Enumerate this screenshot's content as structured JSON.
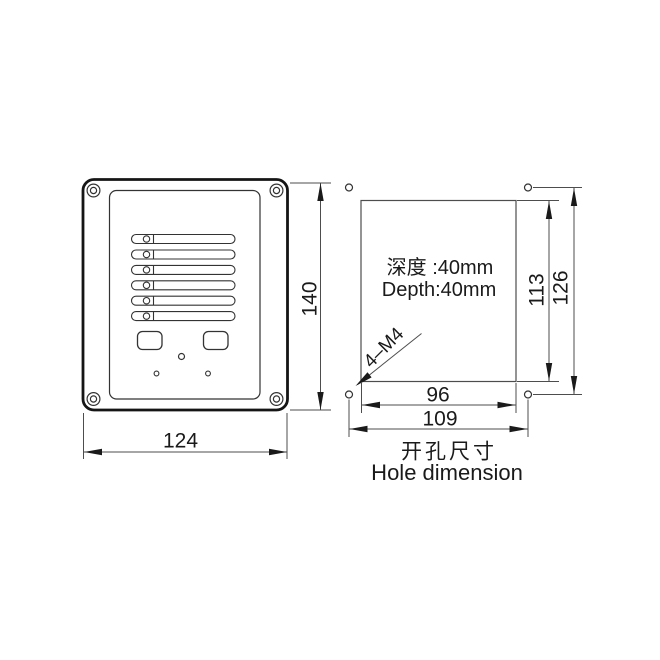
{
  "drawing_type": "technical engineering drawing",
  "front_view": {
    "description": "front panel with six speaker slots, two buttons, mounting screws",
    "dims": {
      "width": "124",
      "height": "140"
    }
  },
  "hole_view": {
    "depth_cn": "深度 :40mm",
    "depth_en": "Depth:40mm",
    "screw_spec": "4–M4",
    "dims": {
      "inner_width": "96",
      "outer_width": "109",
      "inner_height": "113",
      "outer_height": "126"
    },
    "caption_cn": "开孔尺寸",
    "caption_en": "Hole dimension"
  },
  "colors": {
    "ink": "#1a1a1a",
    "panel_line": "#333333",
    "dim_line": "#4d4d4d",
    "background": "#ffffff"
  }
}
